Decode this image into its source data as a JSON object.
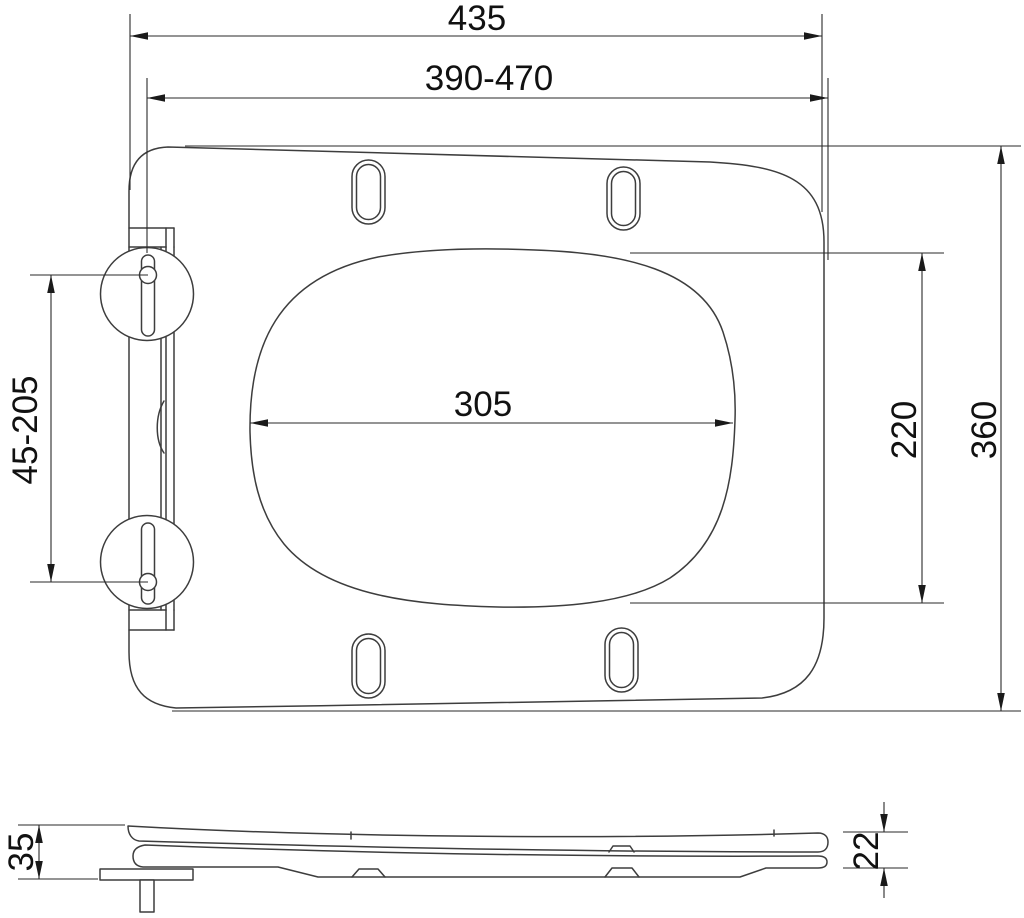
{
  "drawing": {
    "kind": "technical-drawing",
    "subject": "toilet-seat-with-mounting-dimensions",
    "background_color": "#ffffff",
    "line_color": "#3d3d3d",
    "dimension_line_color": "#2a2a2a",
    "text_color": "#111111",
    "top_view": {
      "dim_overall_width": "435",
      "dim_mounting_range": "390-470",
      "dim_opening_width": "305",
      "dim_opening_depth": "220",
      "dim_overall_depth": "360",
      "dim_hinge_range": "45-205"
    },
    "side_view": {
      "dim_height_with_hinge": "35",
      "dim_profile_thickness": "22"
    }
  }
}
